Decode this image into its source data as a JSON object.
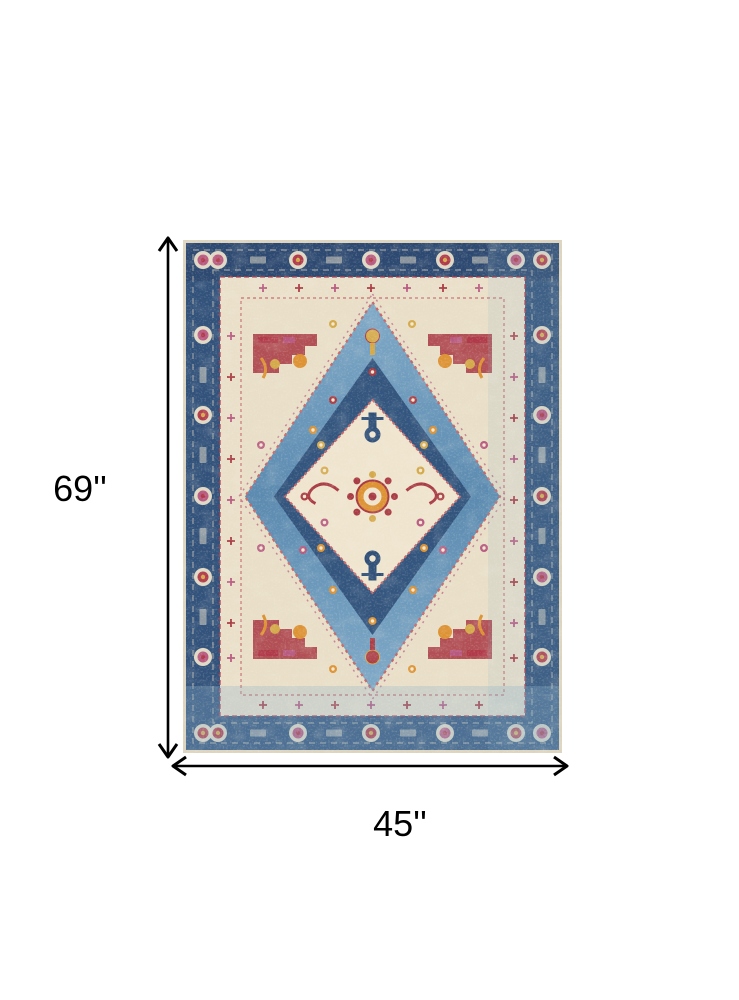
{
  "figure": {
    "description": "Distressed Persian-style medallion area rug in blue, ivory, red and orange",
    "background": "#ffffff"
  },
  "dimensions": {
    "height_label": "69''",
    "width_label": "45''",
    "arrow_color": "#000000",
    "label_color": "#000000"
  },
  "rug_colors": {
    "edge_cream": "#ddd4bf",
    "border_navy": "#32527b",
    "border_navy_dark": "#273f66",
    "ivory": "#eae0ca",
    "field_cream": "#e9dfc8",
    "light_blue": "#7fa9c7",
    "medium_blue": "#5b8ab0",
    "diamond_navy": "#2f4f78",
    "medallion_cream": "#efe5cf",
    "red": "#a93b44",
    "crimson": "#b03a49",
    "orange": "#dd9233",
    "gold": "#d4a94a",
    "magenta": "#b85a80",
    "rose_line": "#c4666a",
    "wash_blue": "#8fb3cb"
  }
}
